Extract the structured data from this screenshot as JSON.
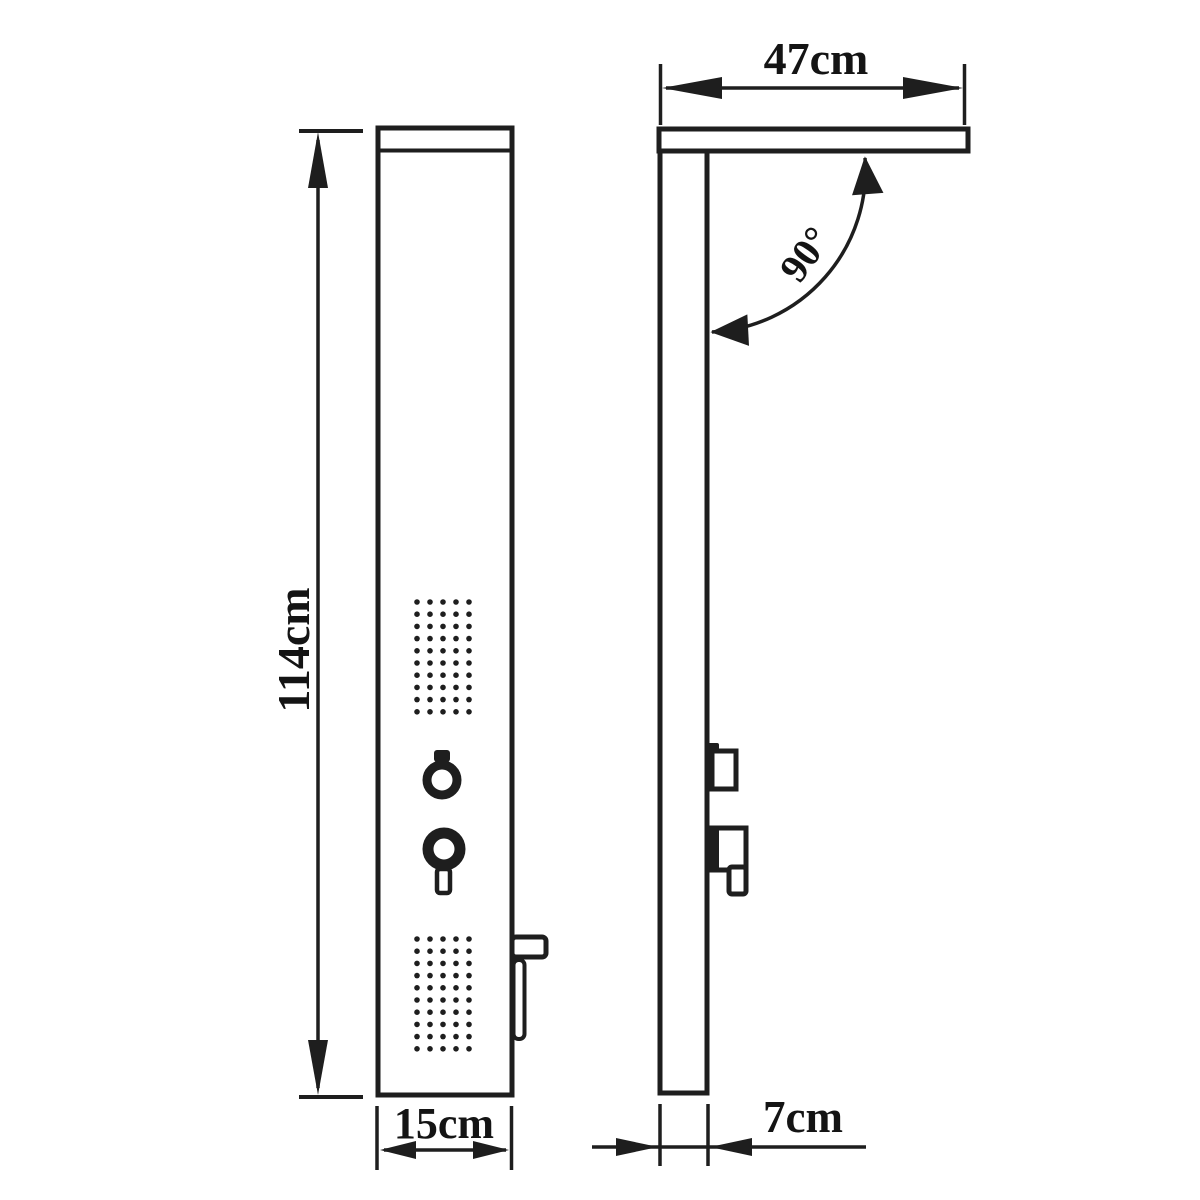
{
  "drawing": {
    "title": "shower-panel-dimension-drawing",
    "colors": {
      "line": "#1e1e1e",
      "background": "#ffffff"
    },
    "front_view": {
      "height_label": "114cm",
      "width_label": "15cm"
    },
    "side_view": {
      "arm_width_label": "47cm",
      "angle_label": "90°",
      "depth_label": "7cm"
    }
  }
}
